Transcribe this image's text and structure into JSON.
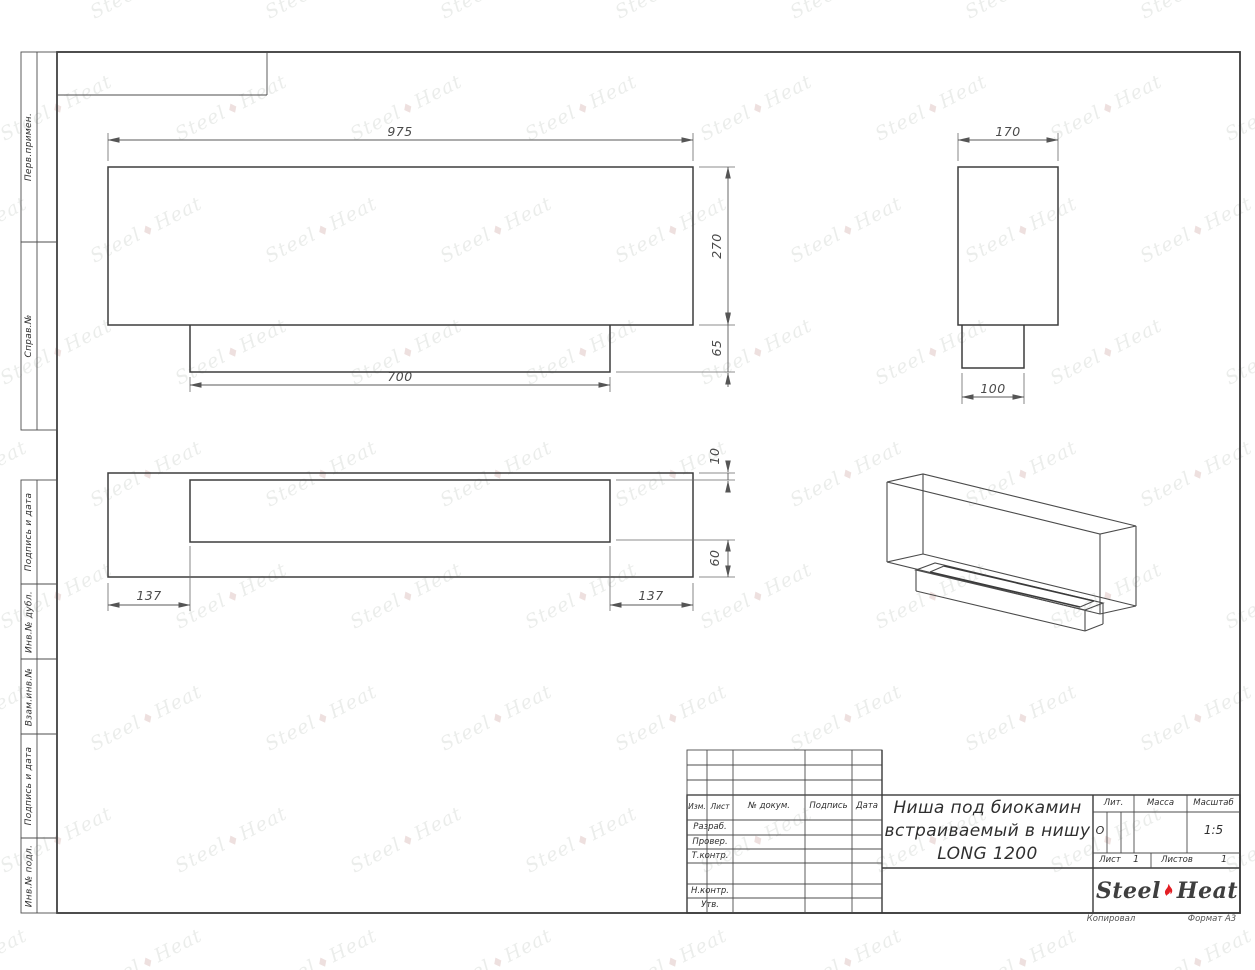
{
  "page": {
    "bg": "#ffffff",
    "line_color": "#4a4a4a",
    "accent_red": "#e31e24"
  },
  "watermark": {
    "word1": "Steel",
    "word2": "Heat",
    "mark": "♦"
  },
  "margin_labels": {
    "perv_primen": "Перв.примен.",
    "sprav_no": "Справ.№",
    "podpis_data_1": "Подпись и дата",
    "inv_dubl": "Инв.№ дубл.",
    "vzam_inv": "Взам.инв.№",
    "podpis_data_2": "Подпись и дата",
    "inv_podl": "Инв.№ подл."
  },
  "views": {
    "front": {
      "dims": {
        "width": "975",
        "height": "270",
        "insert_height": "65",
        "insert_width": "700"
      }
    },
    "side": {
      "dims": {
        "depth": "170",
        "insert_depth": "100"
      }
    },
    "plan": {
      "dims": {
        "top_offset": "10",
        "bottom_offset": "60",
        "left_offset": "137",
        "right_offset": "137"
      }
    }
  },
  "title_block": {
    "header": {
      "izm": "Изм.",
      "list": "Лист",
      "doc_no": "№ докум.",
      "podpis": "Подпись",
      "data": "Дата"
    },
    "rows": [
      {
        "label": "Разраб."
      },
      {
        "label": "Провер."
      },
      {
        "label": "Т.контр."
      },
      {
        "label": "Н.контр."
      },
      {
        "label": "Утв."
      }
    ],
    "title_line1": "Ниша под биокамин",
    "title_line2": "встраиваемый в нишу",
    "title_line3": "LONG 1200",
    "lit": {
      "label": "Лит.",
      "value": "О"
    },
    "massa": {
      "label": "Масса",
      "value": ""
    },
    "masshtab": {
      "label": "Масштаб",
      "value": "1:5"
    },
    "list": {
      "label": "Лист",
      "value": "1"
    },
    "listov": {
      "label": "Листов",
      "value": "1"
    },
    "logo": {
      "word1": "Steel",
      "word2": "Heat"
    }
  },
  "footer": {
    "kopiroval": "Копировал",
    "format": "Формат А3"
  }
}
